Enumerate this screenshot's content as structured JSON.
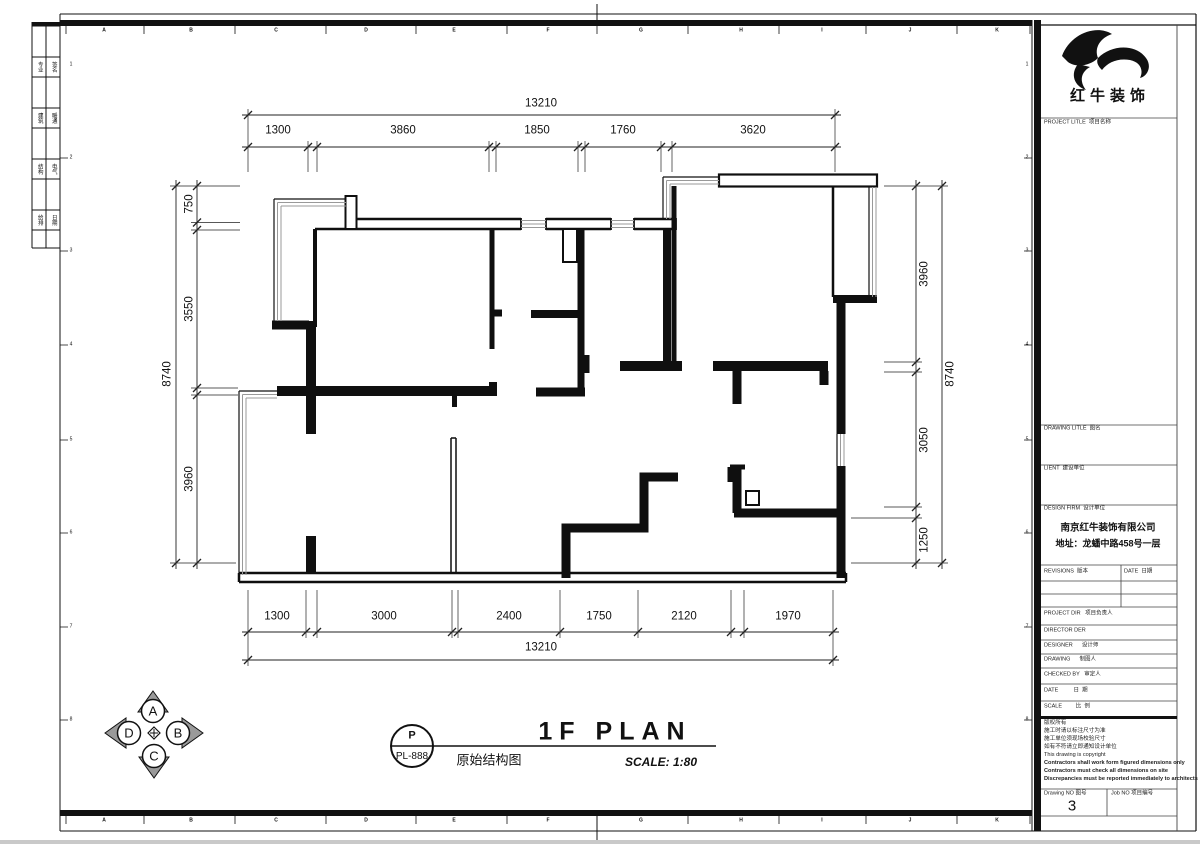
{
  "sheet": {
    "ruler_letters": [
      "A",
      "B",
      "C",
      "D",
      "E",
      "F",
      "G",
      "H",
      "I",
      "J",
      "K"
    ],
    "zone_numbers": [
      "1",
      "2",
      "3",
      "4",
      "5",
      "6",
      "7",
      "8"
    ]
  },
  "left_strip": {
    "rows": [
      [
        "专业",
        "签名"
      ],
      [
        "建筑",
        "暖通"
      ],
      [
        "结构",
        "电气"
      ],
      [
        "给排",
        "日期"
      ]
    ]
  },
  "dims": {
    "top": {
      "overall": "13210",
      "segments": [
        "1300",
        "3860",
        "1850",
        "1760",
        "3620"
      ]
    },
    "bottom": {
      "overall": "13210",
      "segments": [
        "1300",
        "3000",
        "2400",
        "1750",
        "2120",
        "1970"
      ]
    },
    "left": {
      "overall": "8740",
      "segments": [
        "750",
        "3550",
        "3960"
      ]
    },
    "right": {
      "overall": "8740",
      "segments": [
        "3960",
        "3050",
        "1250"
      ]
    }
  },
  "titlebar": {
    "plan_title": "1F PLAN",
    "plan_subtitle": "原始结构图",
    "scale_text": "SCALE: 1:80",
    "bubble_top": "P",
    "bubble_bottom": "PL-888"
  },
  "compass": {
    "north": "A",
    "east": "B",
    "south": "C",
    "west": "D"
  },
  "title_block": {
    "logo_text": "红牛装饰",
    "project_title_label": "PROJECT LITLE  项目名称",
    "drawing_title_label": "DRAWING LITLE  图名",
    "client_label": "LIENT  建设单位",
    "design_firm_label": "DESIGN FIRM  设计单位",
    "firm_name": "南京红牛装饰有限公司",
    "firm_address": "地址：龙蟠中路458号一层",
    "revisions_label": "REVISIONS  版本",
    "date_label": "DATE  日期",
    "project_dir_label": "PROJECT DIR   项目负责人",
    "director_label": "DIRECTOR DER",
    "designer_label": "DESIGNER      设计师",
    "drawing_label": "DRAWING      制图人",
    "checked_label": "CHECKED BY   审定人",
    "date_row_label": "DATE          日  期",
    "scale_row_label": "SCALE         比  例",
    "notes": [
      "版权所有",
      "施工时请以标注尺寸为准",
      "施工单位须现场校验尺寸",
      "如有不符请立即通知设计单位",
      "This drawing is copyright",
      "Contractors shall work form figured dimensions only",
      "Contractors must check all dimensions on site",
      "Discrepancies must be reported immediately to architects"
    ],
    "drawing_no_label": "Drawing NO 图号",
    "drawing_no": "3",
    "job_no_label": "Job NO 项目编号"
  }
}
